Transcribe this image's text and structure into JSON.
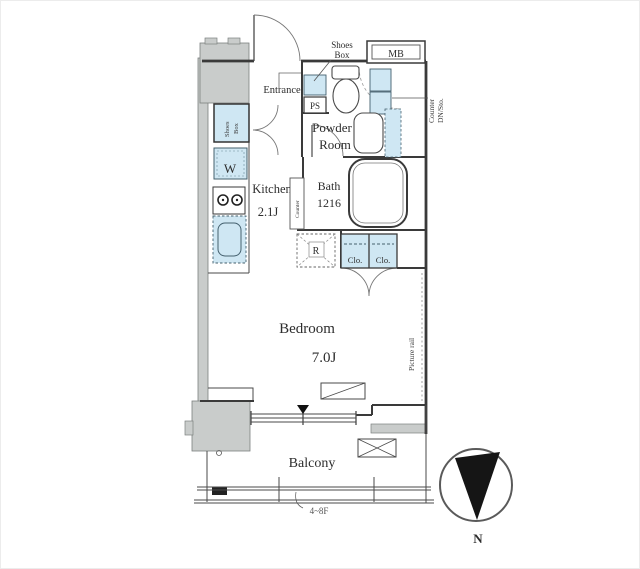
{
  "plan": {
    "title": "apartment-floor-plan",
    "colors": {
      "fixture_blue": "#cfe7f3",
      "wall_gray": "#c9cccb",
      "line_dark": "#3a3a3a",
      "compass_black": "#151515"
    },
    "labels": {
      "shoes_box_callout": {
        "l1": "Shoes",
        "l2": "Box"
      },
      "mb": "MB",
      "entrance": "Entrance",
      "ps": "PS",
      "counter_dn": {
        "l1": "Counter",
        "l2": "DN/Sto."
      },
      "powder_room": {
        "l1": "Powder",
        "l2": "Room"
      },
      "kitchen_cabinet": {
        "l1": "Shoes",
        "l2": "Box"
      },
      "washer": "W",
      "kitchen": {
        "name": "Kitchen",
        "size": "2.1J"
      },
      "bath": {
        "name": "Bath",
        "size": "1216"
      },
      "counter_thin": "Counter",
      "fridge": "R",
      "closet_left": "Clo.",
      "closet_right": "Clo.",
      "picture_rail": "Picture rail",
      "bedroom": {
        "name": "Bedroom",
        "size": "7.0J"
      },
      "balcony": "Balcony",
      "floor_range": "4~8F",
      "north": "N"
    }
  }
}
